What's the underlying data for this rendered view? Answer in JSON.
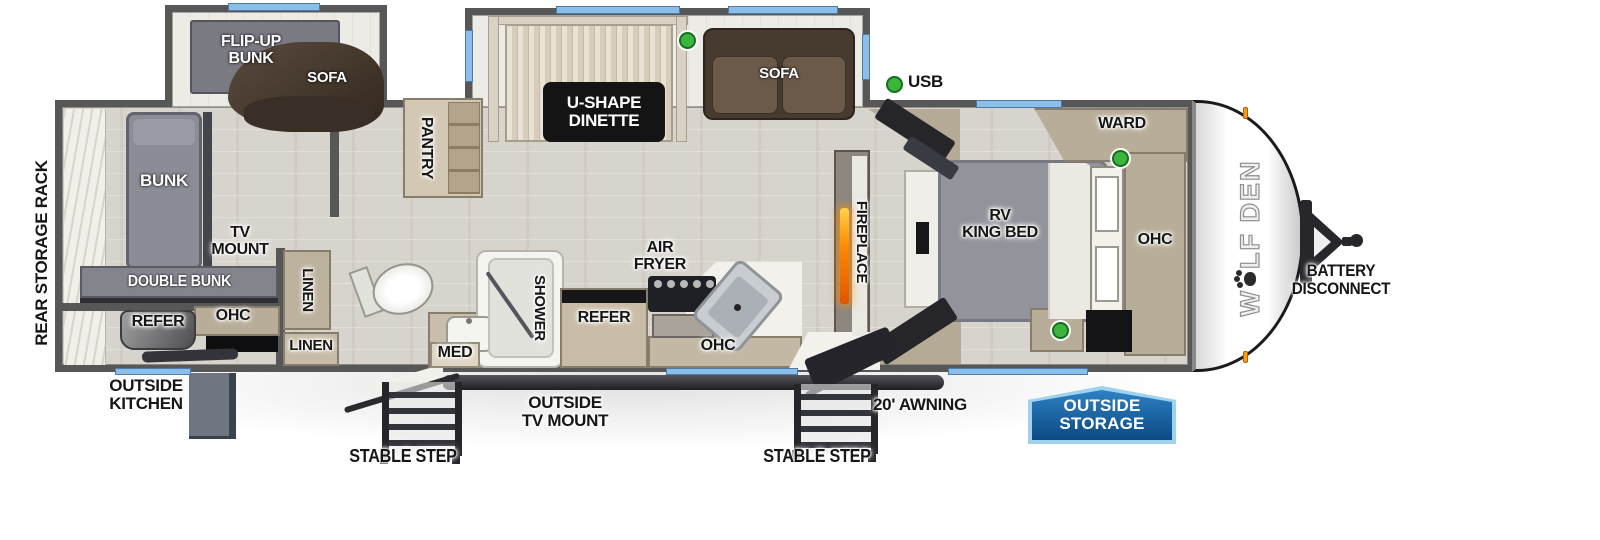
{
  "title": "Wolf Den travel trailer floorplan",
  "brand": {
    "logo_prefix": "W",
    "logo_suffix": "LF DEN"
  },
  "colors": {
    "wall": "#575757",
    "floor": "#d7d3cd",
    "slide_floor": "#edebe6",
    "window_blue": "#8bbfe9",
    "sofa_brown": "#46382e",
    "bunk_gray": "#84848d",
    "cabinet_tan": "#b8ad99",
    "fireplace_orange": "#ff8a00",
    "indicator_green": "#3cb53c",
    "marker_light_orange": "#f59a23",
    "storage_badge_fill": "#0c4a84",
    "storage_badge_border": "#9fd2ec",
    "dinette_label_box": "#141414"
  },
  "labels": {
    "rear_storage_rack": "REAR STORAGE RACK",
    "flip_up_bunk": "FLIP-UP\nBUNK",
    "sofa_bunk": "SOFA",
    "u_shape_dinette": "U-SHAPE\nDINETTE",
    "sofa_living": "SOFA",
    "usb": "USB",
    "pantry": "PANTRY",
    "bunk": "BUNK",
    "tv_mount": "TV\nMOUNT",
    "double_bunk": "DOUBLE BUNK",
    "refer_rear": "REFER",
    "ohc_rear": "OHC",
    "linen_vertical": "LINEN",
    "linen_horizontal": "LINEN",
    "med": "MED",
    "shower": "SHOWER",
    "refer_kitchen": "REFER",
    "air_fryer": "AIR\nFRYER",
    "ohc_kitchen": "OHC",
    "fireplace": "FIREPLACE",
    "rv_king_bed": "RV\nKING BED",
    "ward": "WARD",
    "ohc_bedroom": "OHC",
    "outside_kitchen": "OUTSIDE\nKITCHEN",
    "stable_step_left": "STABLE STEP",
    "outside_tv_mount": "OUTSIDE\nTV MOUNT",
    "stable_step_right": "STABLE STEP",
    "awning": "20' AWNING",
    "outside_storage": "OUTSIDE\nSTORAGE",
    "battery_disconnect": "BATTERY\nDISCONNECT"
  }
}
